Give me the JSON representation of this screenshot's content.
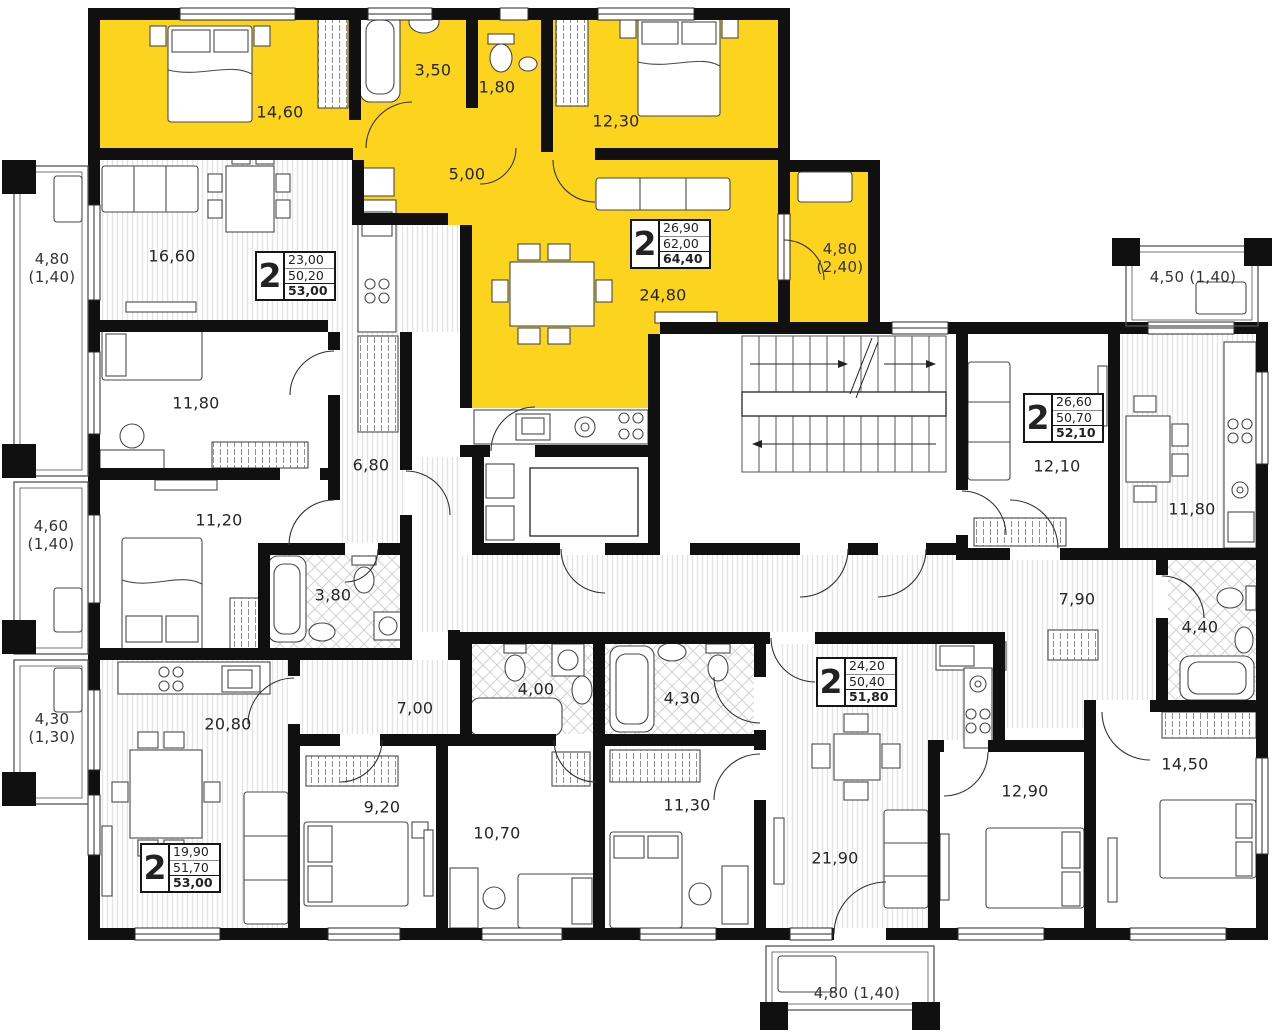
{
  "highlight_color": "#fcd31d",
  "apartments": {
    "yellow": {
      "rooms": "2",
      "living": "26,90",
      "area": "62,00",
      "total": "64,40"
    },
    "left": {
      "rooms": "2",
      "living": "23,00",
      "area": "50,20",
      "total": "53,00"
    },
    "bottom_left": {
      "rooms": "2",
      "living": "19,90",
      "area": "51,70",
      "total": "53,00"
    },
    "bottom_mid": {
      "rooms": "2",
      "living": "24,20",
      "area": "50,40",
      "total": "51,80"
    },
    "right": {
      "rooms": "2",
      "living": "26,60",
      "area": "50,70",
      "total": "52,10"
    }
  },
  "labels": {
    "bedroom1": "14,60",
    "bath1": "3,50",
    "wc1": "1,80",
    "bedroom2": "12,30",
    "hall1": "5,00",
    "living1": "24,80",
    "balc_y_a": "4,80",
    "balc_y_b": "(2,40)",
    "living_left": "16,60",
    "bed_left1": "11,80",
    "bed_left2": "11,20",
    "hall_left": "6,80",
    "bath_left": "3,80",
    "balc_l1a": "4,80",
    "balc_l1b": "(1,40)",
    "balc_l2a": "4,60",
    "balc_l2b": "(1,40)",
    "balc_l3a": "4,30",
    "balc_l3b": "(1,30)",
    "living_bl": "20,80",
    "bed_bl1": "9,20",
    "bed_bl2": "10,70",
    "hall_bl": "7,00",
    "bath_bl": "4,00",
    "bath_bm": "4,30",
    "bed_bm1": "11,30",
    "living_bm": "21,90",
    "bed_bm2": "12,90",
    "living_r": "12,10",
    "kitchen_r": "11,80",
    "hall_r": "7,90",
    "bath_r": "4,40",
    "bed_r": "14,50",
    "balc_right": "4,50 (1,40)",
    "balc_bottom": "4,80 (1,40)"
  }
}
